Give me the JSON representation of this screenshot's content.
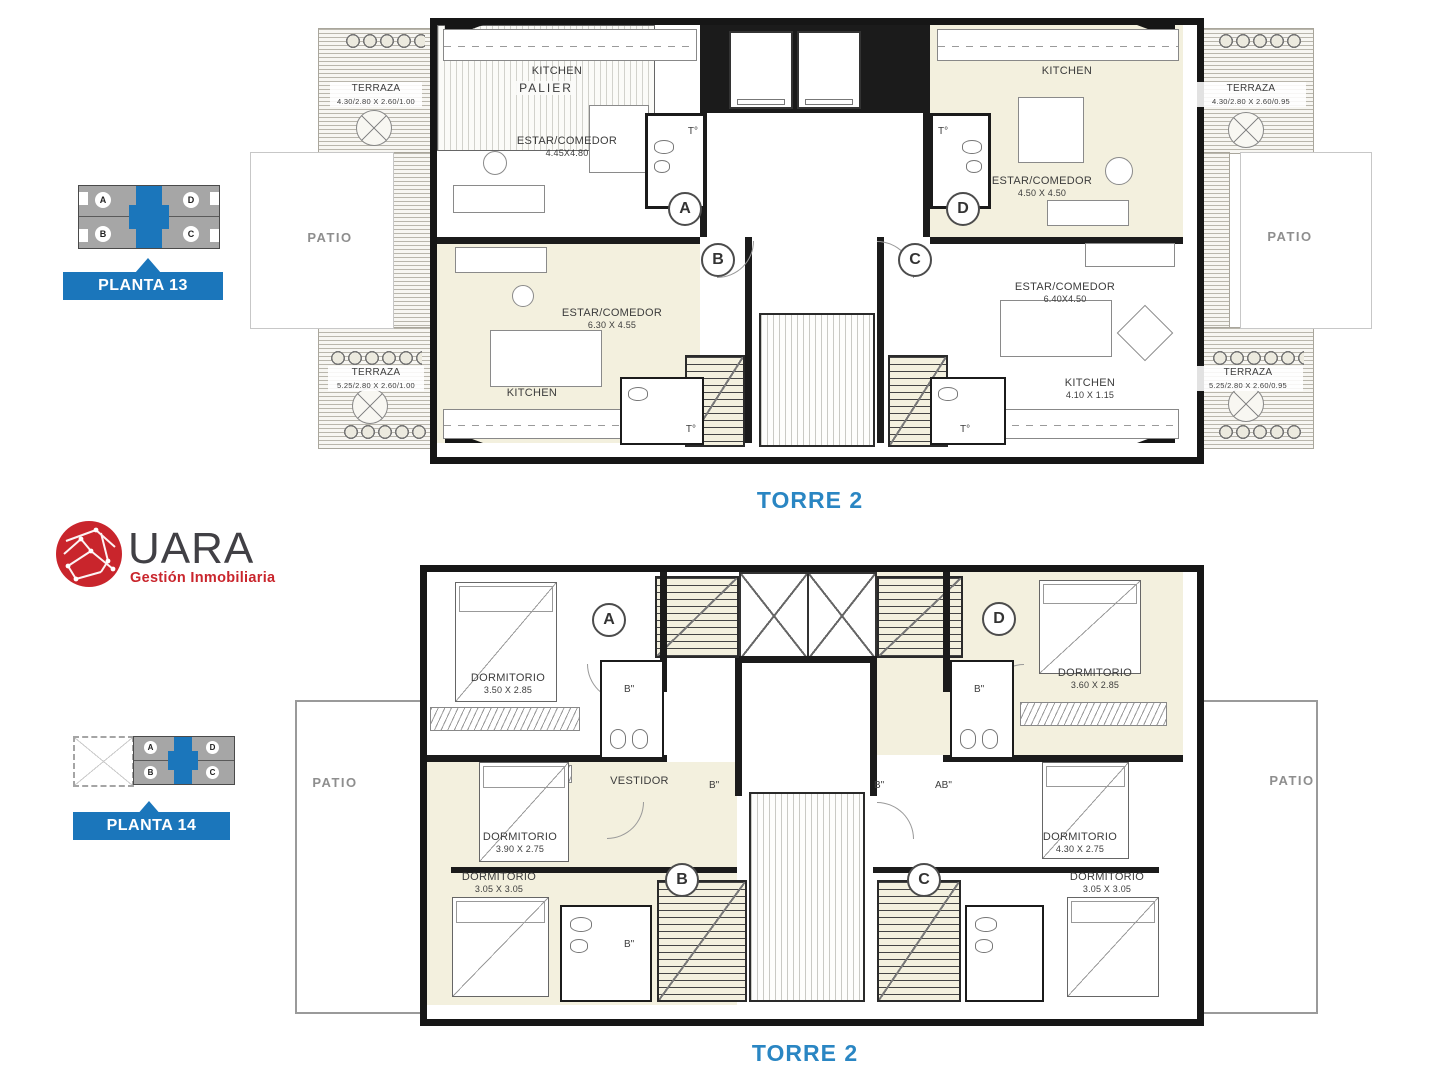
{
  "logo": {
    "name": "UARA",
    "tagline": "Gestión Inmobiliaria"
  },
  "key_plans": [
    {
      "label": "PLANTA 13",
      "units": {
        "a": "A",
        "b": "B",
        "c": "C",
        "d": "D"
      }
    },
    {
      "label": "PLANTA 14",
      "units": {
        "a": "A",
        "b": "B",
        "c": "C",
        "d": "D"
      }
    }
  ],
  "plan13": {
    "torre": "TORRE 2",
    "palier": "PALIER",
    "patio": "PATIO",
    "toilet": "T°",
    "units": {
      "a": "A",
      "b": "B",
      "c": "C",
      "d": "D"
    },
    "terrazas": {
      "top_left": {
        "name": "TERRAZA",
        "dims": "4.30/2.80 X 2.60/1.00"
      },
      "top_right": {
        "name": "TERRAZA",
        "dims": "4.30/2.80 X 2.60/0.95"
      },
      "bottom_left": {
        "name": "TERRAZA",
        "dims": "5.25/2.80 X 2.60/1.00"
      },
      "bottom_right": {
        "name": "TERRAZA",
        "dims": "5.25/2.80 X 2.60/0.95"
      }
    },
    "rooms": {
      "kitchen_a": {
        "name": "KITCHEN",
        "dims": ""
      },
      "estar_a": {
        "name": "ESTAR/COMEDOR",
        "dims": "4.45X4.80"
      },
      "kitchen_d": {
        "name": "KITCHEN",
        "dims": ""
      },
      "estar_d": {
        "name": "ESTAR/COMEDOR",
        "dims": "4.50 X 4.50"
      },
      "estar_b": {
        "name": "ESTAR/COMEDOR",
        "dims": "6.30 X 4.55"
      },
      "kitchen_b": {
        "name": "KITCHEN",
        "dims": ""
      },
      "estar_c": {
        "name": "ESTAR/COMEDOR",
        "dims": "6.40X4.50"
      },
      "kitchen_c": {
        "name": "KITCHEN",
        "dims": "4.10 X 1.15"
      }
    }
  },
  "plan14": {
    "torre": "TORRE 2",
    "patio": "PATIO",
    "bath": "B\"",
    "bath_ab": "AB\"",
    "units": {
      "a": "A",
      "b": "B",
      "c": "C",
      "d": "D"
    },
    "rooms": {
      "dorm_a": {
        "name": "DORMITORIO",
        "dims": "3.50 X 2.85"
      },
      "dorm_d": {
        "name": "DORMITORIO",
        "dims": "3.60 X 2.85"
      },
      "vestidor": {
        "name": "VESTIDOR",
        "dims": ""
      },
      "dorm_b1": {
        "name": "DORMITORIO",
        "dims": "3.90 X 2.75"
      },
      "dorm_b2": {
        "name": "DORMITORIO",
        "dims": "3.05 X 3.05"
      },
      "dorm_c1": {
        "name": "DORMITORIO",
        "dims": "4.30 X 2.75"
      },
      "dorm_c2": {
        "name": "DORMITORIO",
        "dims": "3.05 X 3.05"
      }
    }
  }
}
